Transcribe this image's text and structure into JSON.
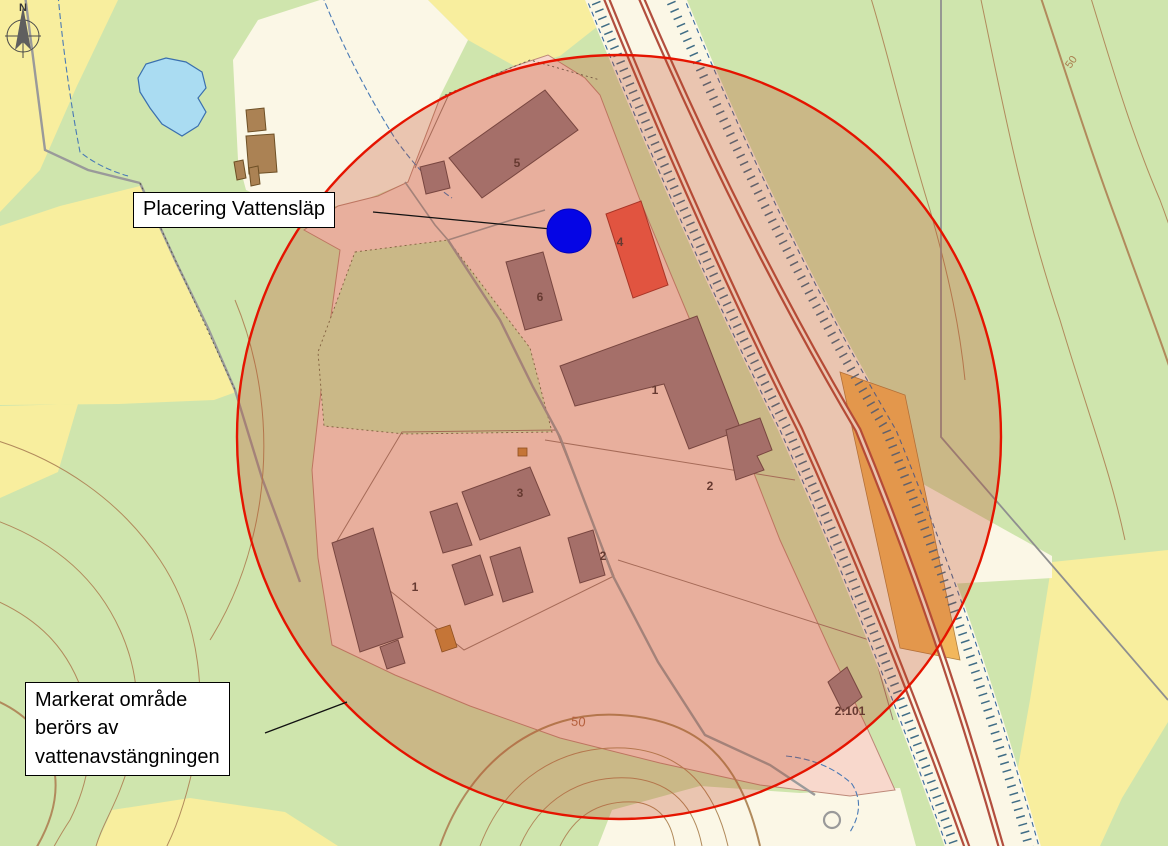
{
  "compass": {
    "label": "N"
  },
  "callouts": {
    "placering": {
      "text": "Placering Vattensläp"
    },
    "markerat": {
      "line1": "Markerat område",
      "line2": "berörs av",
      "line3": "vattenavstängningen"
    }
  },
  "building_labels": {
    "b5": "5",
    "b4": "4",
    "b6": "6",
    "b1_north": "1",
    "b2_north": "2",
    "b3_south": "3",
    "b2_south": "2",
    "b1_south": "1",
    "parcel_2101": "2:101"
  },
  "contour_labels": {
    "northeast": "50",
    "south": "50"
  },
  "colors": {
    "zone_stroke_red": "#e51400",
    "zone_fill": "rgba(190,70,35,0.28)",
    "marker_blue": "#0505e5",
    "building_red": "#ef5a4c",
    "building_red_stroke": "#a03028",
    "parcel_orange": "#f2b75c",
    "parcel_orange_stroke": "#b08040"
  }
}
